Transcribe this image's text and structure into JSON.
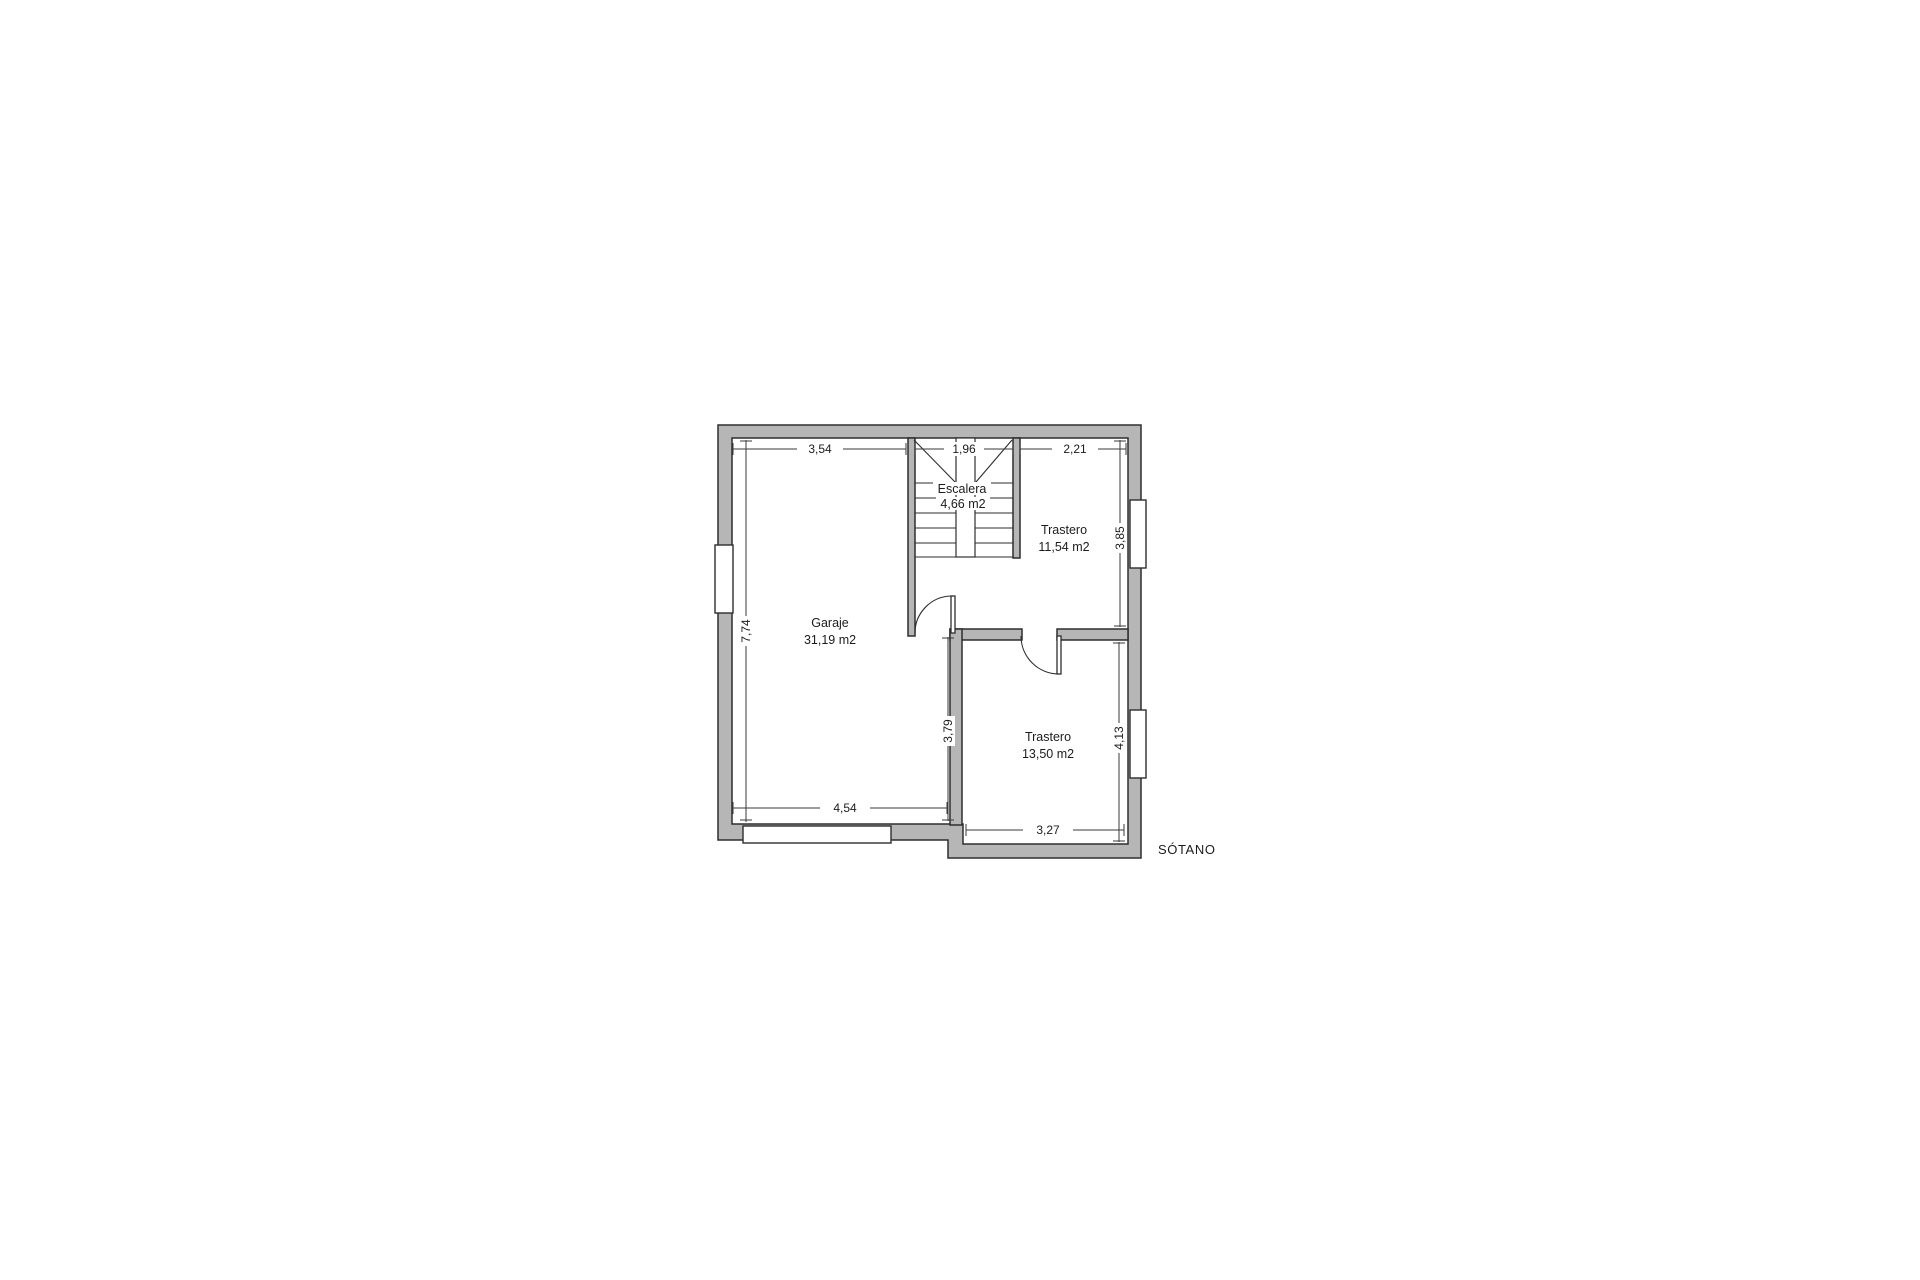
{
  "floorplan": {
    "title": "SÓTANO",
    "rooms": [
      {
        "name": "Garaje",
        "area": "31,19 m2"
      },
      {
        "name": "Escalera",
        "area": "4,66 m2"
      },
      {
        "name": "Trastero",
        "area": "11,54 m2"
      },
      {
        "name": "Trastero",
        "area": "13,50 m2"
      }
    ],
    "dimensions": {
      "garage_width": "3,54",
      "stair_width": "1,96",
      "trastero_top_width": "2,21",
      "garage_height": "7,74",
      "trastero_top_height": "3,85",
      "trastero_bottom_height": "4,13",
      "garage_lower_height": "3,79",
      "garage_bottom_width": "4,54",
      "trastero_bottom_width": "3,27"
    },
    "colors": {
      "background": "#ffffff",
      "wall_fill": "#b6b6b6",
      "wall_line": "#2e2e2e",
      "dim_line": "#3a3a3a",
      "text": "#1c1c1c"
    }
  }
}
